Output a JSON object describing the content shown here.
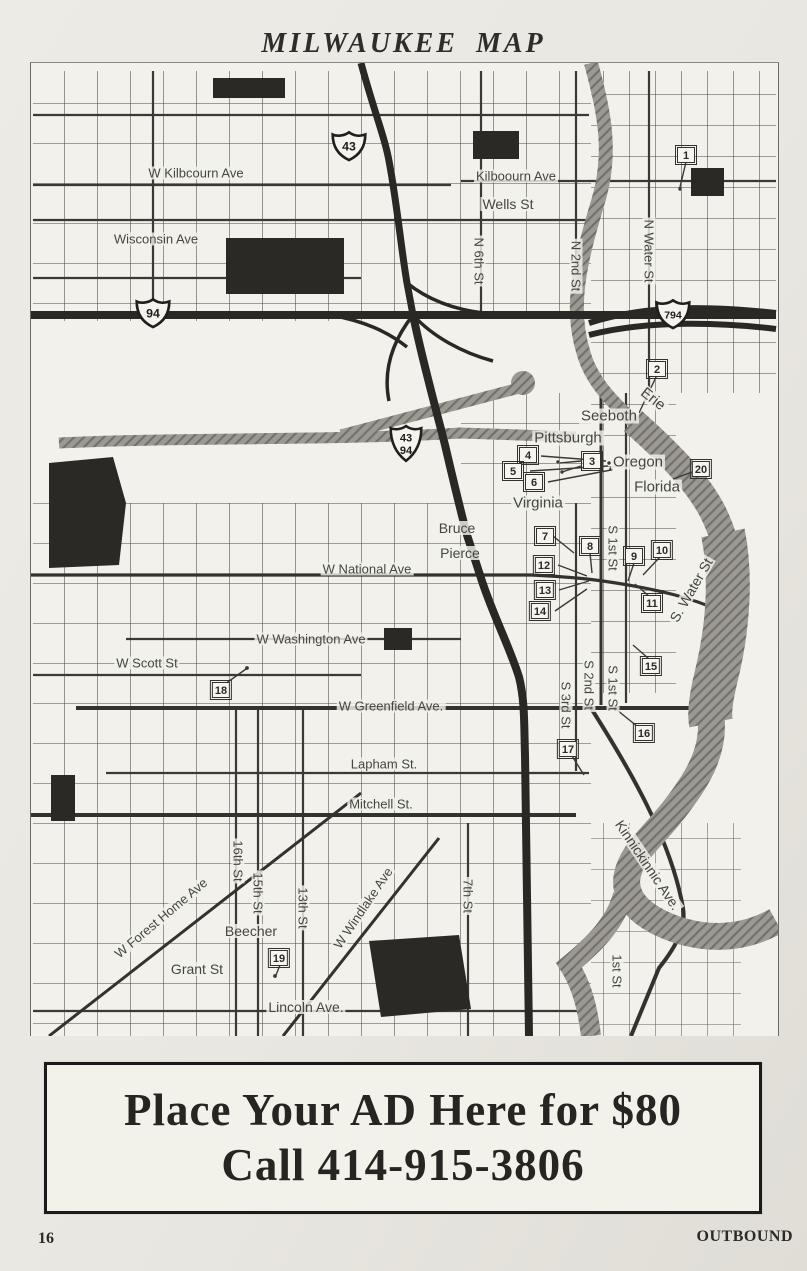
{
  "page": {
    "title": "MILWAUKEE MAP",
    "page_number": "16",
    "footer_right": "OUTBOUND"
  },
  "ad": {
    "line1": "Place Your AD Here for $80",
    "line2": "Call 414-915-3806"
  },
  "colors": {
    "road": "#3b3935",
    "freeway": "#2a2824",
    "river_base": "#9b9992",
    "river_hatch": "#71706a",
    "block": "#2b2926",
    "paper": "#e9e7e1",
    "map_bg": "#f2f1eb",
    "ink": "#2e2d2a"
  },
  "map": {
    "street_labels": [
      {
        "text": "W Kilbcourn Ave",
        "x": 165,
        "y": 110,
        "rot": 0
      },
      {
        "text": "Wisconsin Ave",
        "x": 125,
        "y": 176,
        "rot": 0
      },
      {
        "text": "Kilboourn Ave",
        "x": 485,
        "y": 113,
        "rot": 0
      },
      {
        "text": "Wells St",
        "x": 477,
        "y": 141,
        "rot": 0,
        "s": 14
      },
      {
        "text": "N 6th St",
        "x": 448,
        "y": 198,
        "rot": 90
      },
      {
        "text": "N 2nd St",
        "x": 545,
        "y": 203,
        "rot": 90
      },
      {
        "text": "N Water St",
        "x": 618,
        "y": 188,
        "rot": 90
      },
      {
        "text": "Erie",
        "x": 622,
        "y": 336,
        "rot": 38,
        "s": 15
      },
      {
        "text": "Seeboth",
        "x": 578,
        "y": 353,
        "rot": 0,
        "s": 15
      },
      {
        "text": "Pittsburgh",
        "x": 537,
        "y": 375,
        "rot": 0,
        "s": 15
      },
      {
        "text": "Oregon",
        "x": 607,
        "y": 399,
        "rot": 0,
        "s": 15
      },
      {
        "text": "Florida",
        "x": 626,
        "y": 424,
        "rot": 0,
        "s": 15
      },
      {
        "text": "Virginia",
        "x": 507,
        "y": 440,
        "rot": 0,
        "s": 15
      },
      {
        "text": "Bruce",
        "x": 426,
        "y": 465,
        "rot": 0,
        "s": 14
      },
      {
        "text": "Pierce",
        "x": 429,
        "y": 490,
        "rot": 0,
        "s": 14
      },
      {
        "text": "W National Ave",
        "x": 336,
        "y": 506,
        "rot": 0
      },
      {
        "text": "S 1st St",
        "x": 582,
        "y": 485,
        "rot": 90
      },
      {
        "text": "S. Water St",
        "x": 660,
        "y": 527,
        "rot": -60,
        "s": 14
      },
      {
        "text": "W Washington Ave",
        "x": 280,
        "y": 576,
        "rot": 0
      },
      {
        "text": "W Scott St",
        "x": 116,
        "y": 600,
        "rot": 0
      },
      {
        "text": "W Greenfield Ave.",
        "x": 360,
        "y": 643,
        "rot": 0
      },
      {
        "text": "S 2nd St",
        "x": 558,
        "y": 622,
        "rot": 90
      },
      {
        "text": "S 1st St",
        "x": 582,
        "y": 625,
        "rot": 90
      },
      {
        "text": "S 3rd St",
        "x": 535,
        "y": 642,
        "rot": 90
      },
      {
        "text": "Lapham St.",
        "x": 353,
        "y": 701,
        "rot": 0
      },
      {
        "text": "Mitchell St.",
        "x": 350,
        "y": 741,
        "rot": 0
      },
      {
        "text": "Kinnickinnic Ave.",
        "x": 617,
        "y": 802,
        "rot": 56,
        "s": 14
      },
      {
        "text": "16th St",
        "x": 207,
        "y": 798,
        "rot": 90
      },
      {
        "text": "15th St",
        "x": 227,
        "y": 830,
        "rot": 90
      },
      {
        "text": "13th St",
        "x": 272,
        "y": 845,
        "rot": 90
      },
      {
        "text": "W Forest Home Ave",
        "x": 130,
        "y": 855,
        "rot": -40
      },
      {
        "text": "Beecher",
        "x": 220,
        "y": 868,
        "rot": 0,
        "s": 14
      },
      {
        "text": "W Windlake Ave",
        "x": 332,
        "y": 845,
        "rot": -56
      },
      {
        "text": "Grant St",
        "x": 166,
        "y": 906,
        "rot": 0,
        "s": 14
      },
      {
        "text": "7th St",
        "x": 437,
        "y": 833,
        "rot": 90
      },
      {
        "text": "Lincoln Ave.",
        "x": 275,
        "y": 944,
        "rot": 0,
        "s": 14
      },
      {
        "text": "1st St",
        "x": 586,
        "y": 908,
        "rot": 90
      }
    ],
    "markers": [
      {
        "label": "1",
        "x": 655,
        "y": 92
      },
      {
        "label": "2",
        "x": 626,
        "y": 306
      },
      {
        "label": "3",
        "x": 561,
        "y": 398
      },
      {
        "label": "4",
        "x": 497,
        "y": 392
      },
      {
        "label": "5",
        "x": 482,
        "y": 408
      },
      {
        "label": "6",
        "x": 503,
        "y": 419
      },
      {
        "label": "7",
        "x": 514,
        "y": 473
      },
      {
        "label": "8",
        "x": 559,
        "y": 483
      },
      {
        "label": "9",
        "x": 603,
        "y": 493
      },
      {
        "label": "10",
        "x": 631,
        "y": 487
      },
      {
        "label": "11",
        "x": 621,
        "y": 540
      },
      {
        "label": "12",
        "x": 513,
        "y": 502
      },
      {
        "label": "13",
        "x": 514,
        "y": 527
      },
      {
        "label": "14",
        "x": 509,
        "y": 548
      },
      {
        "label": "15",
        "x": 620,
        "y": 603
      },
      {
        "label": "16",
        "x": 613,
        "y": 670
      },
      {
        "label": "17",
        "x": 537,
        "y": 686
      },
      {
        "label": "18",
        "x": 190,
        "y": 627
      },
      {
        "label": "19",
        "x": 248,
        "y": 895
      },
      {
        "label": "20",
        "x": 670,
        "y": 406
      }
    ],
    "shields": [
      {
        "lines": [
          "43"
        ],
        "x": 318,
        "y": 83
      },
      {
        "lines": [
          "94"
        ],
        "x": 122,
        "y": 250
      },
      {
        "lines": [
          "794"
        ],
        "x": 642,
        "y": 251
      },
      {
        "lines": [
          "43",
          "94"
        ],
        "x": 375,
        "y": 380
      }
    ]
  }
}
